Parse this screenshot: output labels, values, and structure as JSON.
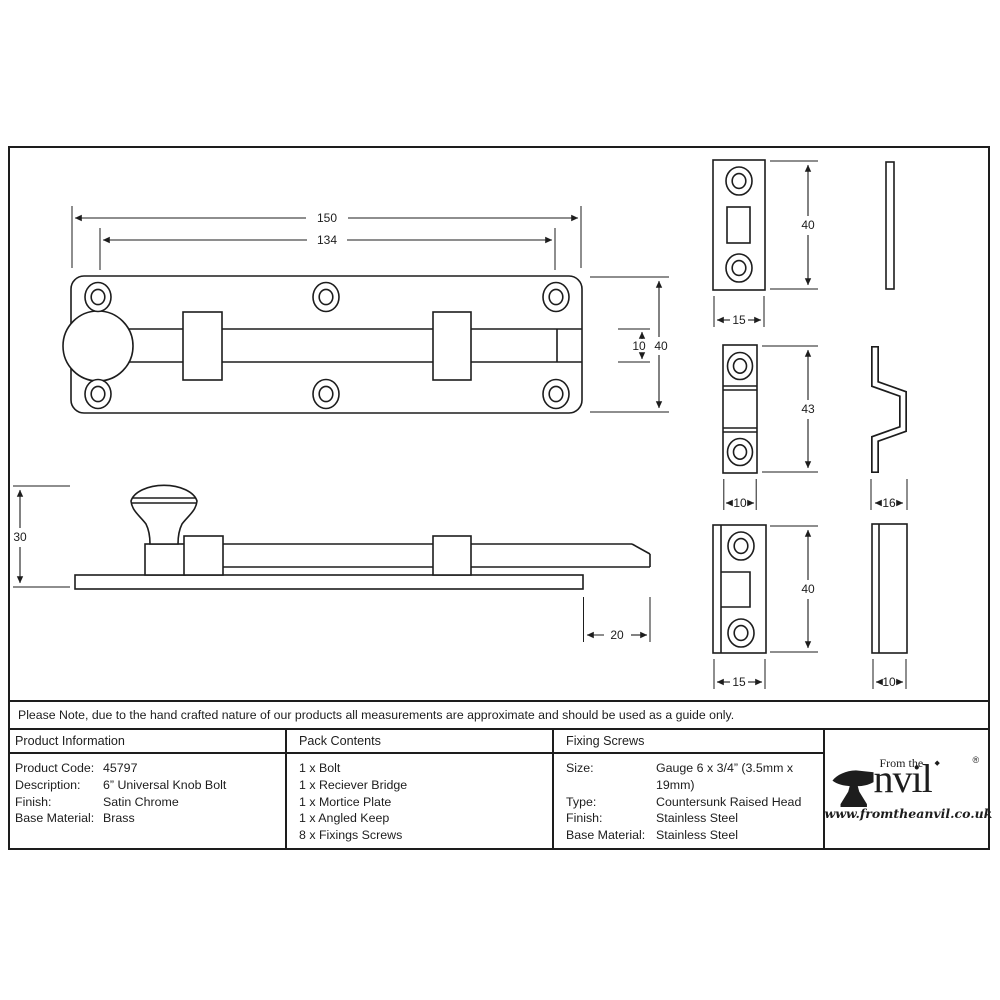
{
  "note": "Please Note, due to the hand crafted nature of our products all measurements are approximate and should be used as a guide only.",
  "drawing": {
    "dims": {
      "top_view": {
        "overall_length": "150",
        "bolt_length": "134",
        "shaft_width": "10",
        "plate_height": "40"
      },
      "side_view": {
        "overall_height": "30",
        "bolt_throw": "20"
      },
      "mortice_plate": {
        "height": "40",
        "width": "15"
      },
      "receiver_bridge": {
        "height": "43",
        "width": "10",
        "profile_depth": "16"
      },
      "angled_keep": {
        "height": "40",
        "width": "15",
        "side_depth": "10"
      }
    }
  },
  "table": {
    "product_information": {
      "title": "Product Information",
      "rows": [
        {
          "label": "Product Code:",
          "value": "45797"
        },
        {
          "label": "Description:",
          "value": "6” Universal Knob Bolt"
        },
        {
          "label": "Finish:",
          "value": "Satin Chrome"
        },
        {
          "label": "Base Material:",
          "value": "Brass"
        }
      ]
    },
    "pack_contents": {
      "title": "Pack Contents",
      "items": [
        "1 x Bolt",
        "1 x Reciever Bridge",
        "1 x Mortice Plate",
        "1 x Angled Keep",
        "8 x Fixings Screws"
      ]
    },
    "fixing_screws": {
      "title": "Fixing Screws",
      "rows": [
        {
          "label": "Size:",
          "value": "Gauge 6 x 3/4” (3.5mm x 19mm)"
        },
        {
          "label": "Type:",
          "value": "Countersunk Raised Head"
        },
        {
          "label": "Finish:",
          "value": "Stainless Steel"
        },
        {
          "label": "Base Material:",
          "value": "Stainless Steel"
        }
      ]
    }
  },
  "brand": {
    "prefix": "From the",
    "ornament": "◆",
    "name_rest": "nvil",
    "registered": "®",
    "url": "www.fromtheanvil.co.uk"
  }
}
